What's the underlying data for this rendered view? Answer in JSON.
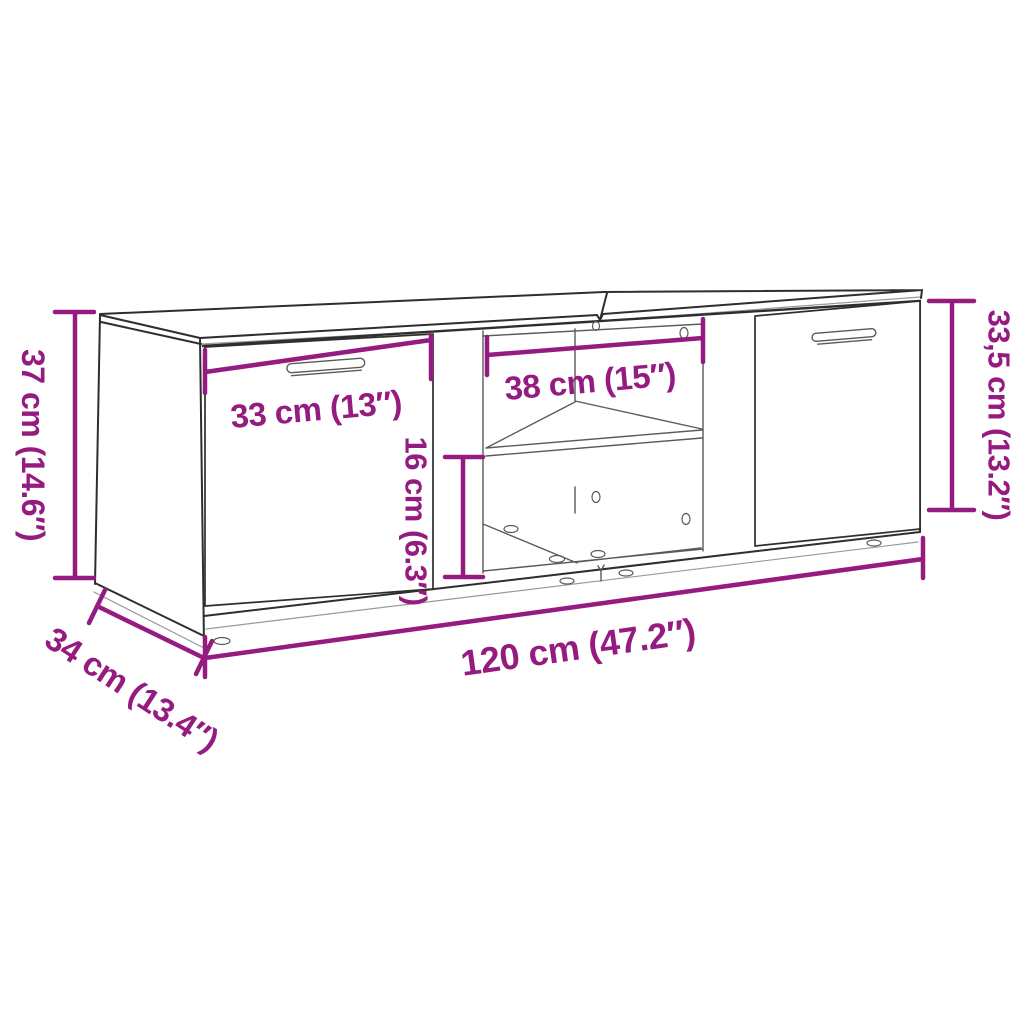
{
  "figure": {
    "name": "tv-cabinet-dimension-diagram",
    "colors": {
      "dimension": "#951B81",
      "outline": "#2e2e2e",
      "detail": "#5a5a5a",
      "faint": "#9a9a9a"
    },
    "dimensions": {
      "overall_height": "37 cm (14.6″)",
      "left_door_width": "33 cm (13″)",
      "shelf_width": "38 cm (15″)",
      "shelf_height": "16 cm (6.3″)",
      "door_height": "33,5 cm (13.2″)",
      "depth": "34 cm (13.4″)",
      "overall_width": "120 cm (47.2″)"
    }
  }
}
